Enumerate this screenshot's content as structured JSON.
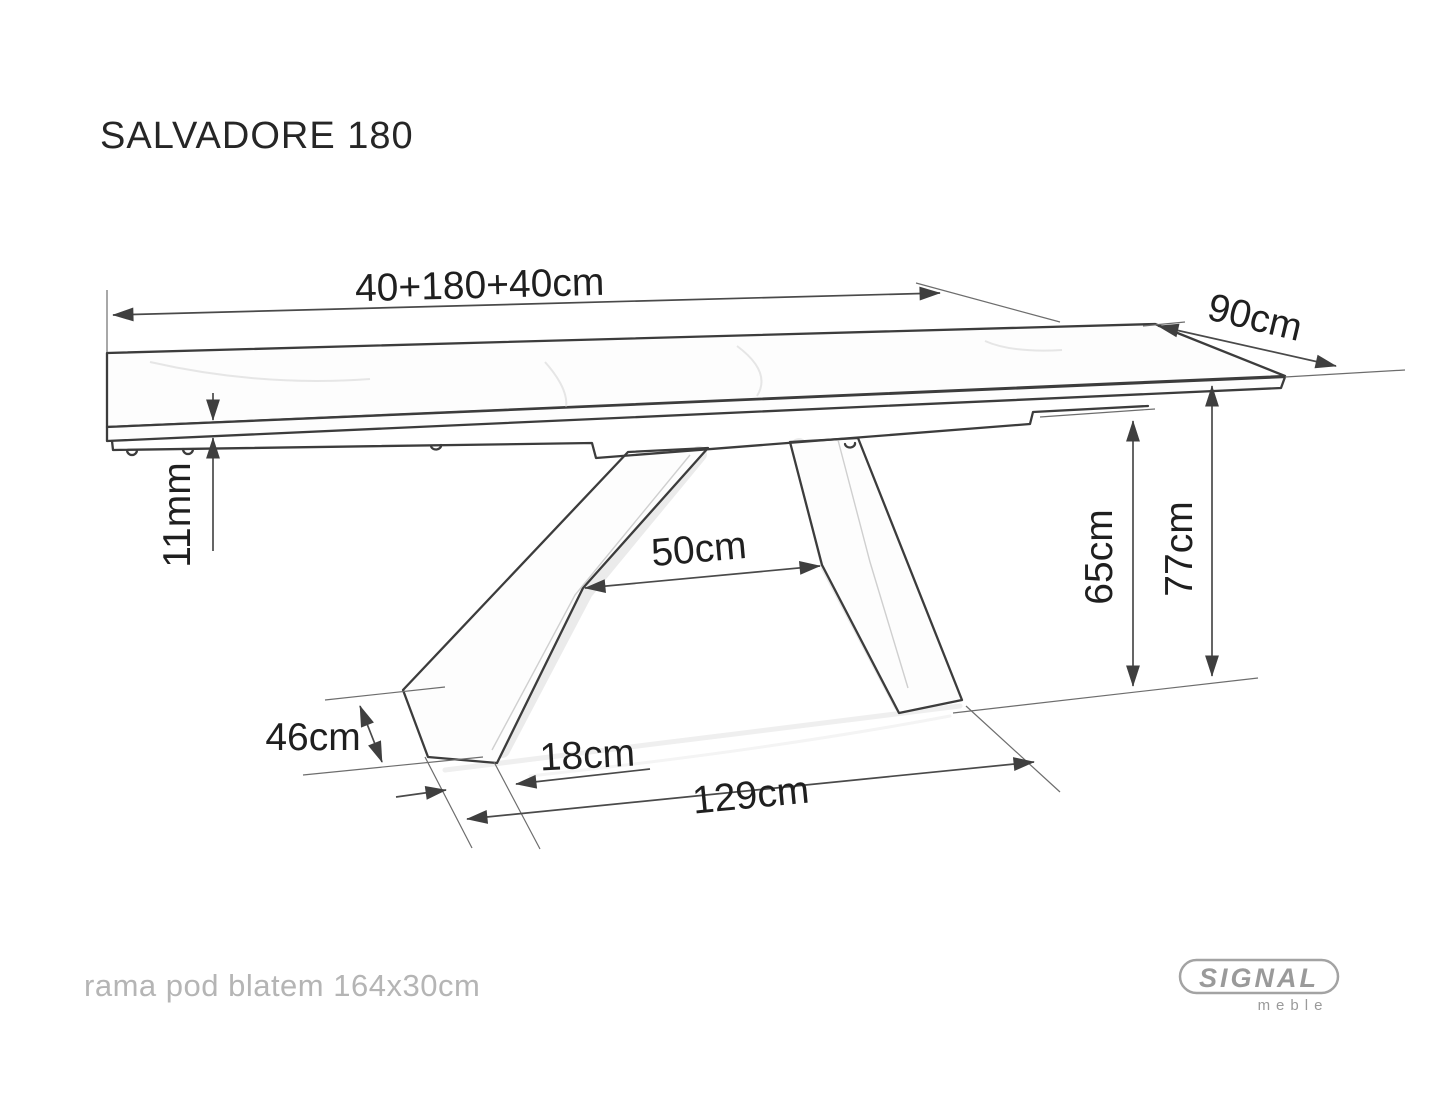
{
  "title": "SALVADORE 180",
  "dimensions": {
    "total_length": "40+180+40cm",
    "depth": "90cm",
    "top_thickness": "11mm",
    "leg_gap": "50cm",
    "underframe_height": "65cm",
    "total_height": "77cm",
    "foot_length": "46cm",
    "foot_width": "18cm",
    "base_length": "129cm"
  },
  "footnote": "rama pod blatem 164x30cm",
  "logo": {
    "brand": "SIGNAL",
    "sub": "meble"
  },
  "colors": {
    "drawing_line": "#3c3c3c",
    "dimension_text": "#1f1f1f",
    "muted_text": "#b5b5b5",
    "logo_gray": "#9a9a9a",
    "background": "#ffffff"
  }
}
